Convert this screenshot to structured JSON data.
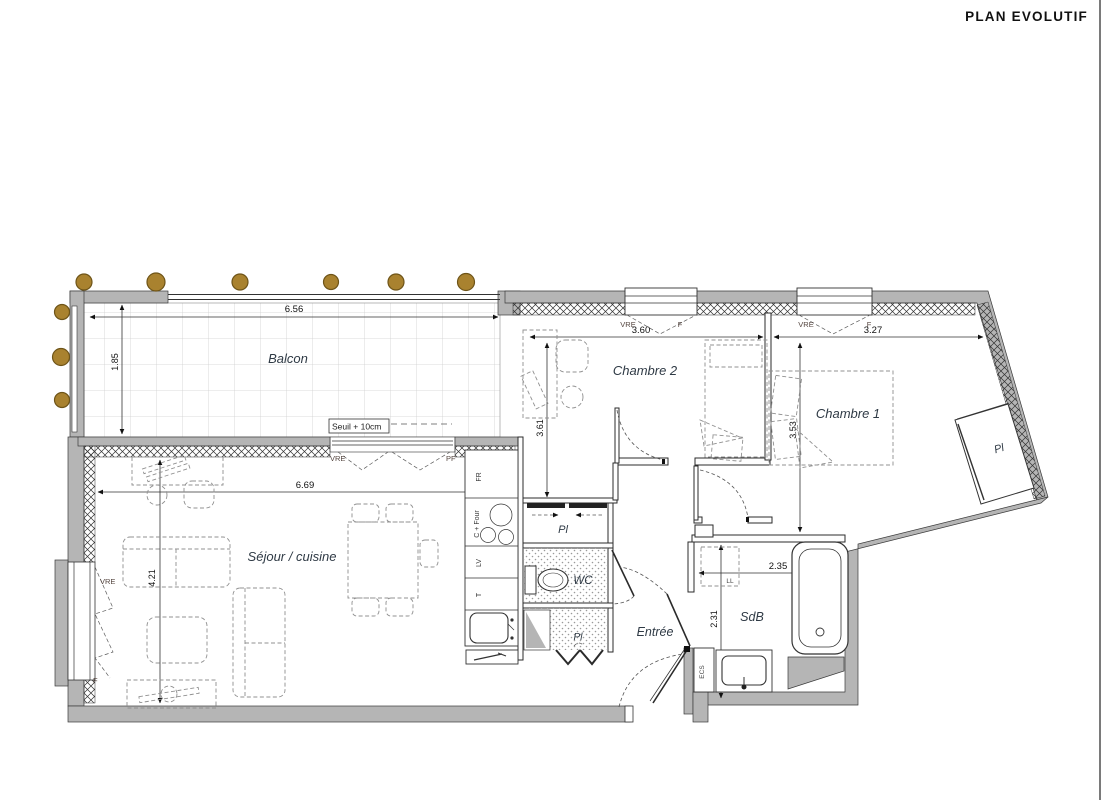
{
  "title": "PLAN EVOLUTIF",
  "rooms": {
    "balcon": "Balcon",
    "sejour": "Séjour / cuisine",
    "chambre2": "Chambre 2",
    "chambre1": "Chambre 1",
    "wc": "WC",
    "sdb": "SdB",
    "entree": "Entrée"
  },
  "storage": {
    "pl": "Pl",
    "ll": "LL",
    "ecs": "ECS"
  },
  "kitchen": {
    "fridge": "FR",
    "oven": "C + Four",
    "dishwasher": "LV",
    "t": "T"
  },
  "dims": {
    "balcon_w": "6.56",
    "balcon_d": "1.85",
    "sejour_w": "6.69",
    "sejour_d": "4.21",
    "chambre2_w": "3.60",
    "chambre2_d": "3.61",
    "chambre1_w": "3.27",
    "chambre1_d": "3.53",
    "sdb_w": "2.35",
    "sdb_d": "2.31"
  },
  "threshold": "Seuil + 10cm",
  "openings": {
    "vre": "VRE",
    "f": "F",
    "pf": "PF"
  },
  "colors": {
    "wall": "#b5b5b5",
    "post": "#a9822f",
    "room_label": "#2f3a45",
    "dim_text": "#111111"
  }
}
